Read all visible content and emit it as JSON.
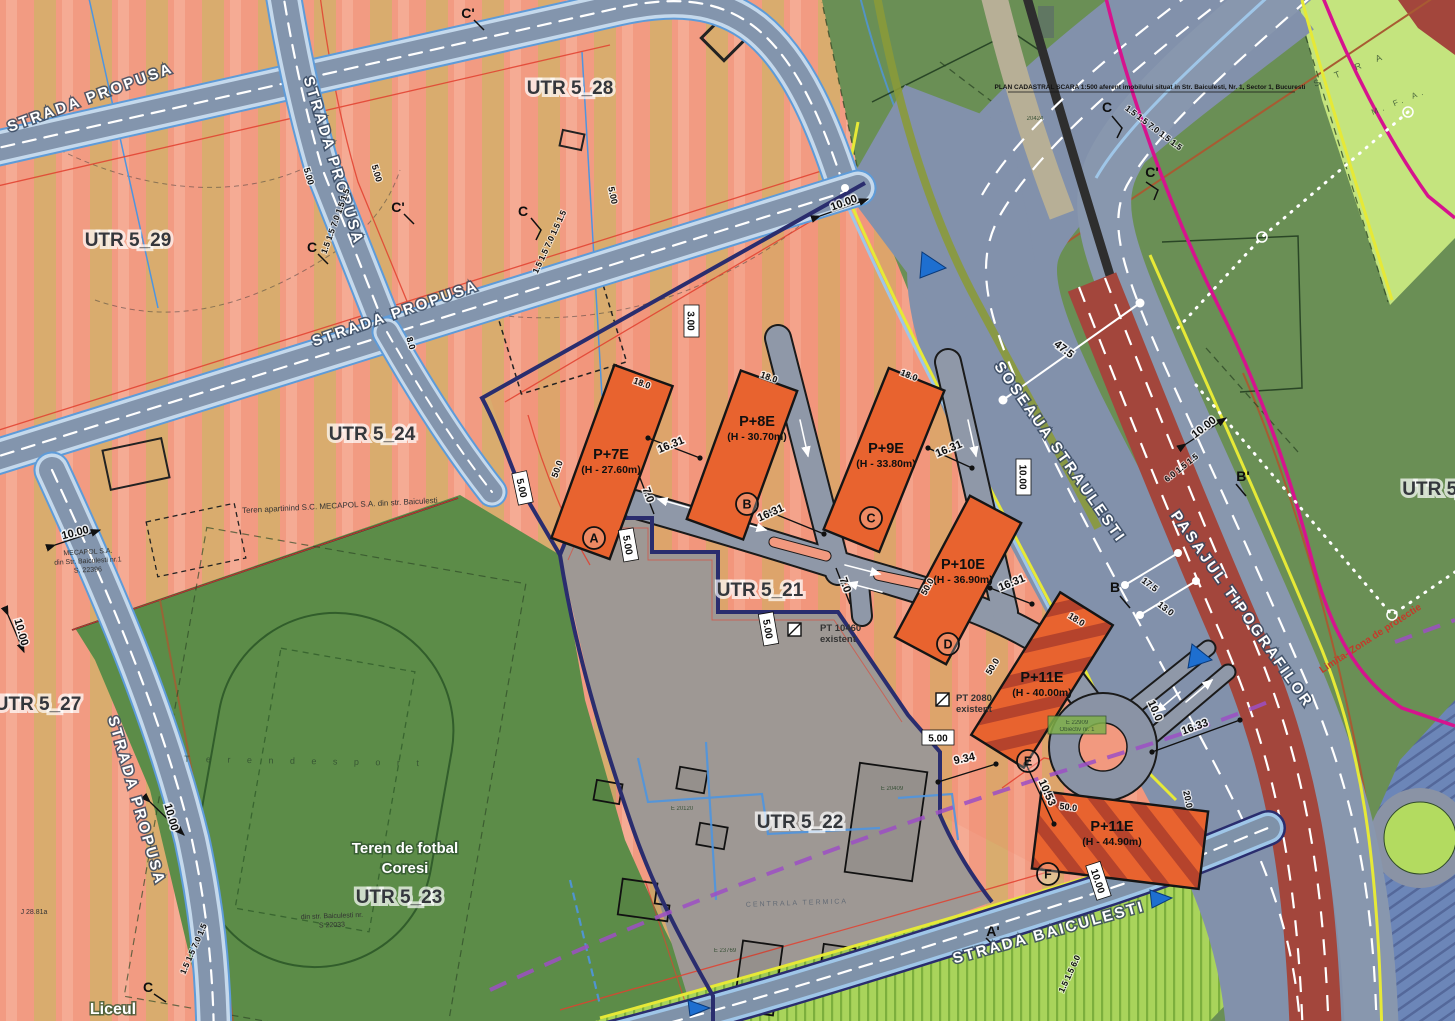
{
  "streets": {
    "propusa": "STRADA PROPUSA",
    "straulesti": "SOSEAUA STRAULESTI",
    "pasajul": "PASAJUL TIPOGRAFILOR",
    "baiculesti": "STRADA BAICULESTI"
  },
  "zones": {
    "u29": "UTR 5_29",
    "u28": "UTR 5_28",
    "u27": "UTR 5_27",
    "u24": "UTR 5_24",
    "u21": "UTR 5_21",
    "u22": "UTR 5_22",
    "u23": "UTR 5_23",
    "u5": "UTR 5_"
  },
  "buildings": [
    {
      "letter": "A",
      "code": "P+7E",
      "height": "(H - 27.60m)"
    },
    {
      "letter": "B",
      "code": "P+8E",
      "height": "(H - 30.70m)"
    },
    {
      "letter": "C",
      "code": "P+9E",
      "height": "(H - 33.80m)"
    },
    {
      "letter": "D",
      "code": "P+10E",
      "height": "(H - 36.90m)"
    },
    {
      "letter": "E",
      "code": "P+11E",
      "height": "(H - 40.00m)"
    },
    {
      "letter": "F",
      "code": "P+11E",
      "height": "(H - 44.90m)"
    }
  ],
  "areas": {
    "football1": "Teren de fotbal",
    "football2": "Coresi",
    "liceul": "Liceul",
    "teren_sport": "T e r e n   d e   s p o r t"
  },
  "notes": {
    "plan": "PLAN CADASTRAL SCARA 1:500 aferent imobilului situat in Str. Baiculesti, Nr. 1, Sector 1, Bucuresti",
    "mecapol_parcel": "Teren apartinind S.C. MECAPOL S.A. din str. Baiculesti",
    "mecapol1": "MECAPOL S.A.",
    "mecapol2": "din Str. Baiculesti nr.1",
    "mecapol3": "S. 22396",
    "pt10460": "PT 10460",
    "pt2080": "PT 2080",
    "existent": "existent",
    "limita": "Limita- Zona de protectie",
    "obiectiv1": "E 22909",
    "obiectiv2": "Obiectiv nr. 1",
    "centrala": "CENTRALA TERMICA",
    "din_str": "din str. Baiculesti nr.",
    "s22033": "S 22033",
    "j2881": "J 28.81a",
    "stra": "S T R A",
    "mfa": "M. F. A.",
    "e20120": "E 20120",
    "e23769": "E 23769",
    "e20409": "E 20409",
    "n20424": "20424"
  },
  "sections": {
    "c": "C",
    "cp": "C'",
    "b": "B",
    "bp": "B'",
    "ap": "A'"
  },
  "dims": {
    "d1631": "16.31",
    "d1633": "16.33",
    "d934": "9.34",
    "d1053": "10.53",
    "d70": "7.0",
    "d300": "3.00",
    "d500": "5.00",
    "d1000": "10.00",
    "d100": "10.0",
    "d475": "47.5",
    "d175": "17.5",
    "d130": "13.0",
    "d180": "18.0",
    "d50": "50.0",
    "d200": "20.0",
    "d80": "8.0",
    "sec5": "1.5 1.5 7.0 1.5 1.5",
    "sec4": "1.5 1.5 7.0 1.5",
    "sec3": "1.5 1.5 6.0",
    "s615": "6.0 1.5 1.5"
  },
  "colors": {
    "salmon": "#F29B82",
    "tan": "#D9AC6E",
    "orange_building": "#E8632F",
    "hatch_red": "#B5432C",
    "green": "#5C8C48",
    "green_right": "#6A8F55",
    "light_green": "#C4E47E",
    "gray_zone": "#9E9894",
    "road_gray": "#8291AB",
    "maroon_road": "#A3463C",
    "yellow_line": "#E6E937",
    "magenta_line": "#D6138E",
    "navy_boundary": "#2A2D6E",
    "purple_dash": "#9C4FC4",
    "blue_triangle": "#1E6FD0"
  }
}
